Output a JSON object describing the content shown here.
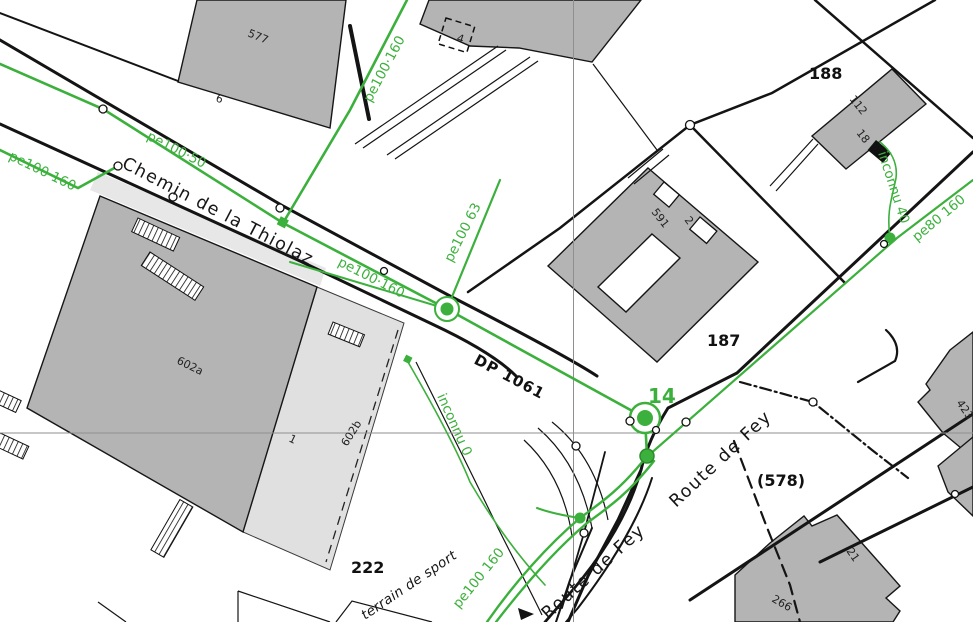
{
  "map": {
    "colors": {
      "pipe_green": "#3cb03c",
      "building_gray": "#b4b4b4",
      "building_light_gray": "#e0e0e0",
      "line_black": "#141414",
      "crosshair_gray": "#8f8f8f",
      "background": "#ffffff"
    },
    "labels": {
      "pipes": [
        {
          "t": "pe100 160",
          "x": 8,
          "y": 159,
          "r": 26
        },
        {
          "t": "pe100·50",
          "x": 146,
          "y": 139,
          "r": 27
        },
        {
          "t": "pe100·160",
          "x": 337,
          "y": 265,
          "r": 27
        },
        {
          "t": "pe100·160",
          "x": 371,
          "y": 103,
          "r": -62
        },
        {
          "t": "pe100 63",
          "x": 452,
          "y": 263,
          "r": -63
        },
        {
          "t": "inconnu 0",
          "x": 437,
          "y": 396,
          "r": 66
        },
        {
          "t": "inconnu 40",
          "x": 878,
          "y": 153,
          "r": 72
        },
        {
          "t": "pe80 160",
          "x": 917,
          "y": 242,
          "r": -40
        },
        {
          "t": "pe100 160",
          "x": 459,
          "y": 609,
          "r": -51
        }
      ],
      "network": [
        {
          "t": "DP 1061",
          "x": 473,
          "y": 363,
          "r": 28
        }
      ],
      "junction": [
        {
          "t": "14",
          "x": 648,
          "y": 403,
          "r": 0
        }
      ],
      "streets": [
        {
          "t": "Chemin de la Thiolaz",
          "x": 121,
          "y": 167,
          "r": 27.5
        },
        {
          "t": "Route de Fey",
          "x": 676,
          "y": 508,
          "r": -43
        },
        {
          "t": "Route de Fey",
          "x": 548,
          "y": 620,
          "r": -42
        },
        {
          "t": "terrain de sport",
          "x": 365,
          "y": 620,
          "r": -34,
          "cls": "small-italic"
        }
      ],
      "buildings": [
        {
          "t": "577",
          "x": 247,
          "y": 36,
          "r": 22
        },
        {
          "t": "6",
          "x": 215,
          "y": 101,
          "r": 20
        },
        {
          "t": "112",
          "x": 849,
          "y": 99,
          "r": 52
        },
        {
          "t": "18",
          "x": 856,
          "y": 133,
          "r": 52
        },
        {
          "t": "591",
          "x": 651,
          "y": 212,
          "r": 52
        },
        {
          "t": "2",
          "x": 684,
          "y": 220,
          "r": 52
        },
        {
          "t": "602a",
          "x": 176,
          "y": 363,
          "r": 26
        },
        {
          "t": "602b",
          "x": 347,
          "y": 447,
          "r": -58
        },
        {
          "t": "1",
          "x": 288,
          "y": 441,
          "r": 26
        },
        {
          "t": "423",
          "x": 956,
          "y": 403,
          "r": 55
        },
        {
          "t": "21",
          "x": 846,
          "y": 551,
          "r": 55
        },
        {
          "t": "266",
          "x": 771,
          "y": 601,
          "r": 30
        },
        {
          "t": "4",
          "x": 456,
          "y": 41,
          "r": 18
        }
      ],
      "parcels": [
        {
          "t": "188",
          "x": 809,
          "y": 79,
          "r": 0
        },
        {
          "t": "187",
          "x": 707,
          "y": 346,
          "r": 0
        },
        {
          "t": "222",
          "x": 351,
          "y": 573,
          "r": 0
        },
        {
          "t": "(578)",
          "x": 757,
          "y": 486,
          "r": 0
        }
      ]
    }
  }
}
